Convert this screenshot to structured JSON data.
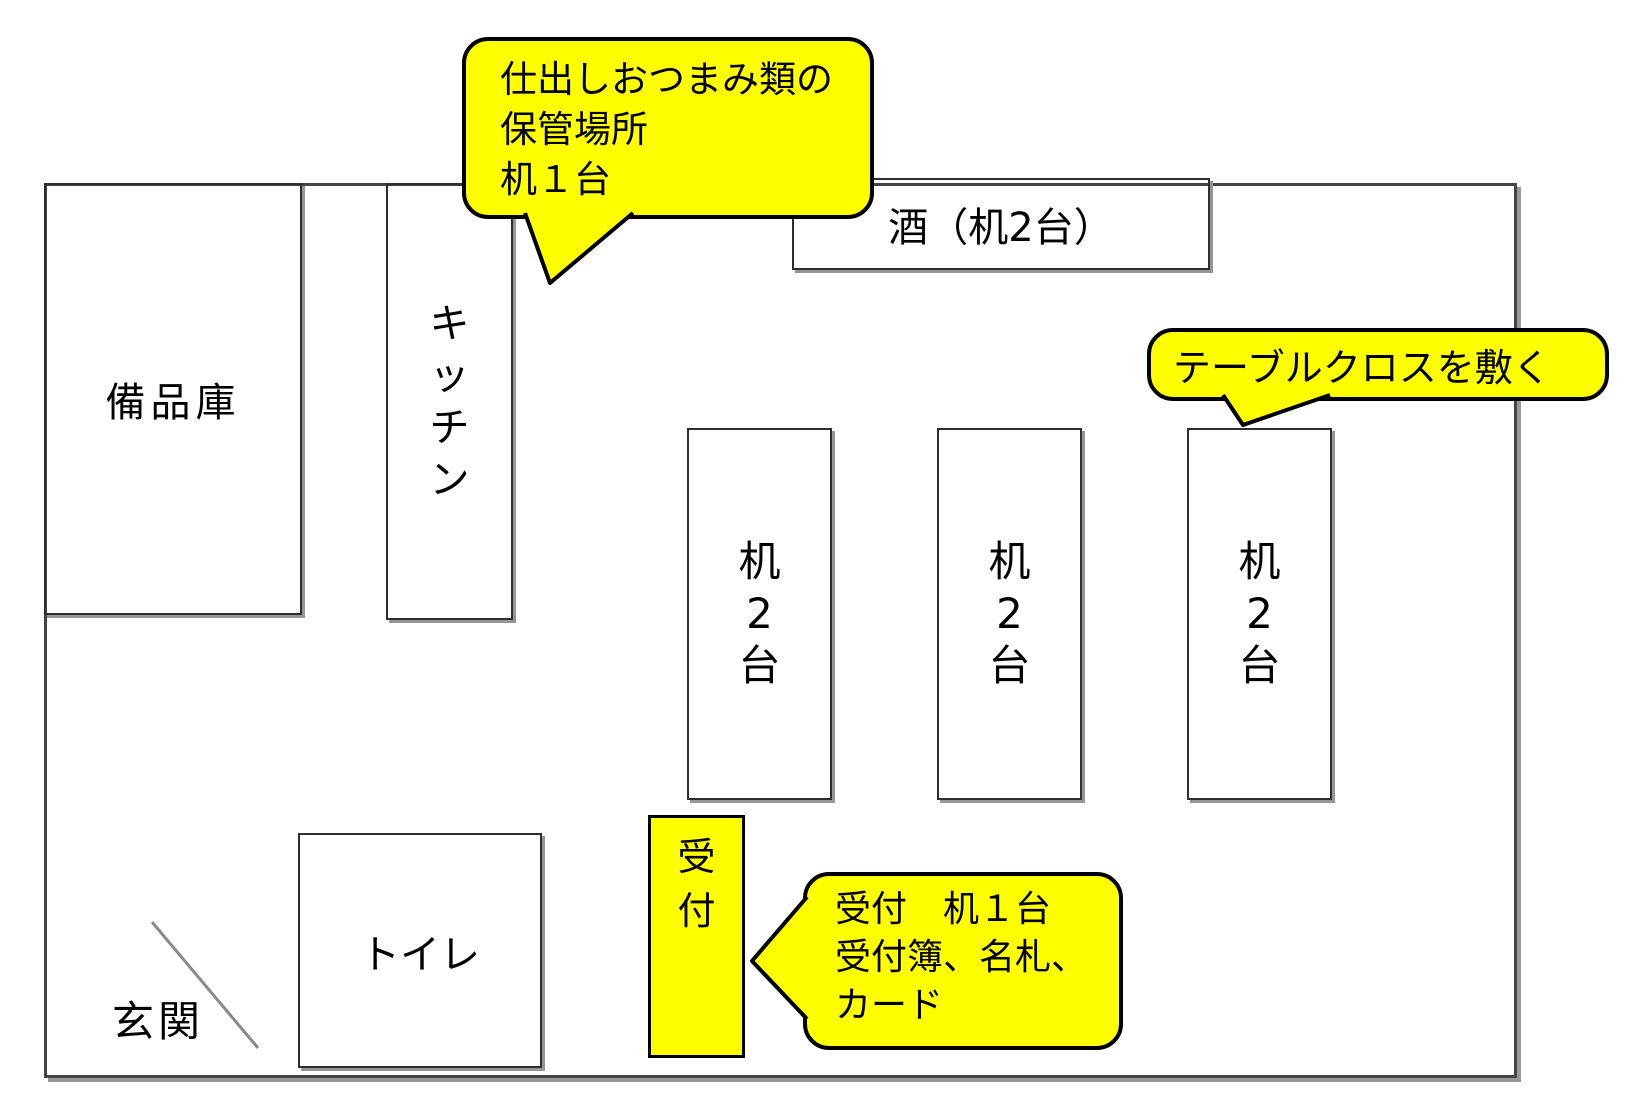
{
  "diagram": {
    "type": "floor-plan",
    "background": "#ffffff",
    "colors": {
      "wall": "#444444",
      "wall_shadow": "#999999",
      "box_border": "#2e2e2e",
      "box_shadow": "#969696",
      "bubble_fill": "#ffff00",
      "bubble_border": "#000000",
      "reception_fill": "#ffff00",
      "door_line": "#8a8a8a"
    }
  },
  "rooms": {
    "storage": {
      "label": "備品庫"
    },
    "kitchen": {
      "label": "キッチン",
      "chars": [
        "キ",
        "ッ",
        "チ",
        "ン"
      ]
    },
    "sake": {
      "label": "酒（机2台）"
    },
    "toilet": {
      "label": "トイレ"
    },
    "entrance": {
      "label": "玄関"
    }
  },
  "desks": [
    {
      "chars": [
        "机",
        "2",
        "台"
      ]
    },
    {
      "chars": [
        "机",
        "2",
        "台"
      ]
    },
    {
      "chars": [
        "机",
        "2",
        "台"
      ]
    }
  ],
  "reception_desk": {
    "chars": [
      "受",
      "付"
    ]
  },
  "bubbles": {
    "catering": {
      "lines": [
        "仕出しおつまみ類の",
        "保管場所",
        "机１台"
      ]
    },
    "tablecloth": {
      "label": "テーブルクロスを敷く"
    },
    "reception_note": {
      "lines": [
        "受付　机１台",
        "受付簿、名札、",
        "カード"
      ]
    }
  }
}
